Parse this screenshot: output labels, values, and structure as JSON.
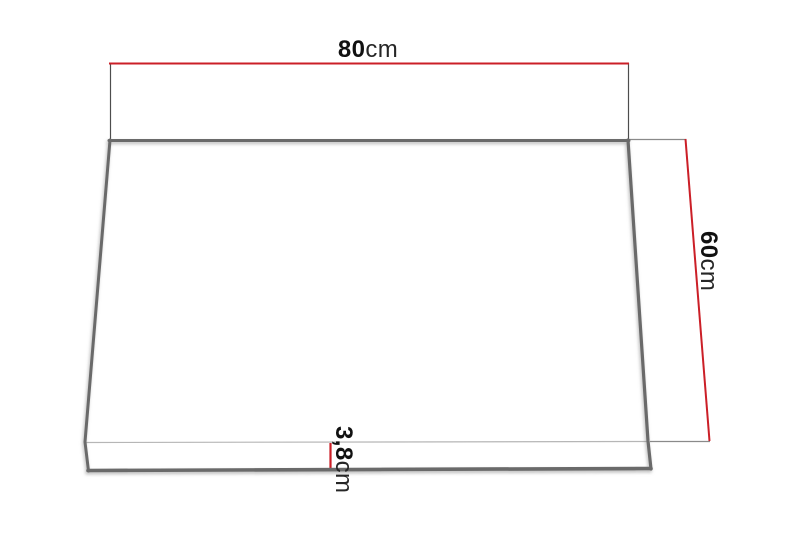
{
  "diagram": {
    "dimensions": {
      "width": {
        "value": "80",
        "unit": "cm"
      },
      "depth": {
        "value": "60",
        "unit": "cm"
      },
      "thickness": {
        "value": "3,8",
        "unit": "cm"
      }
    },
    "colors": {
      "dimension_red": "#cb1f27",
      "panel_edge_gray": "#6a6a6a",
      "extension_dark": "#4d4d4d",
      "extension_gray": "#8a8a8a",
      "front_edge_light": "#b6b6b6",
      "panel_fill": "#ffffff",
      "text": "#161616"
    }
  }
}
